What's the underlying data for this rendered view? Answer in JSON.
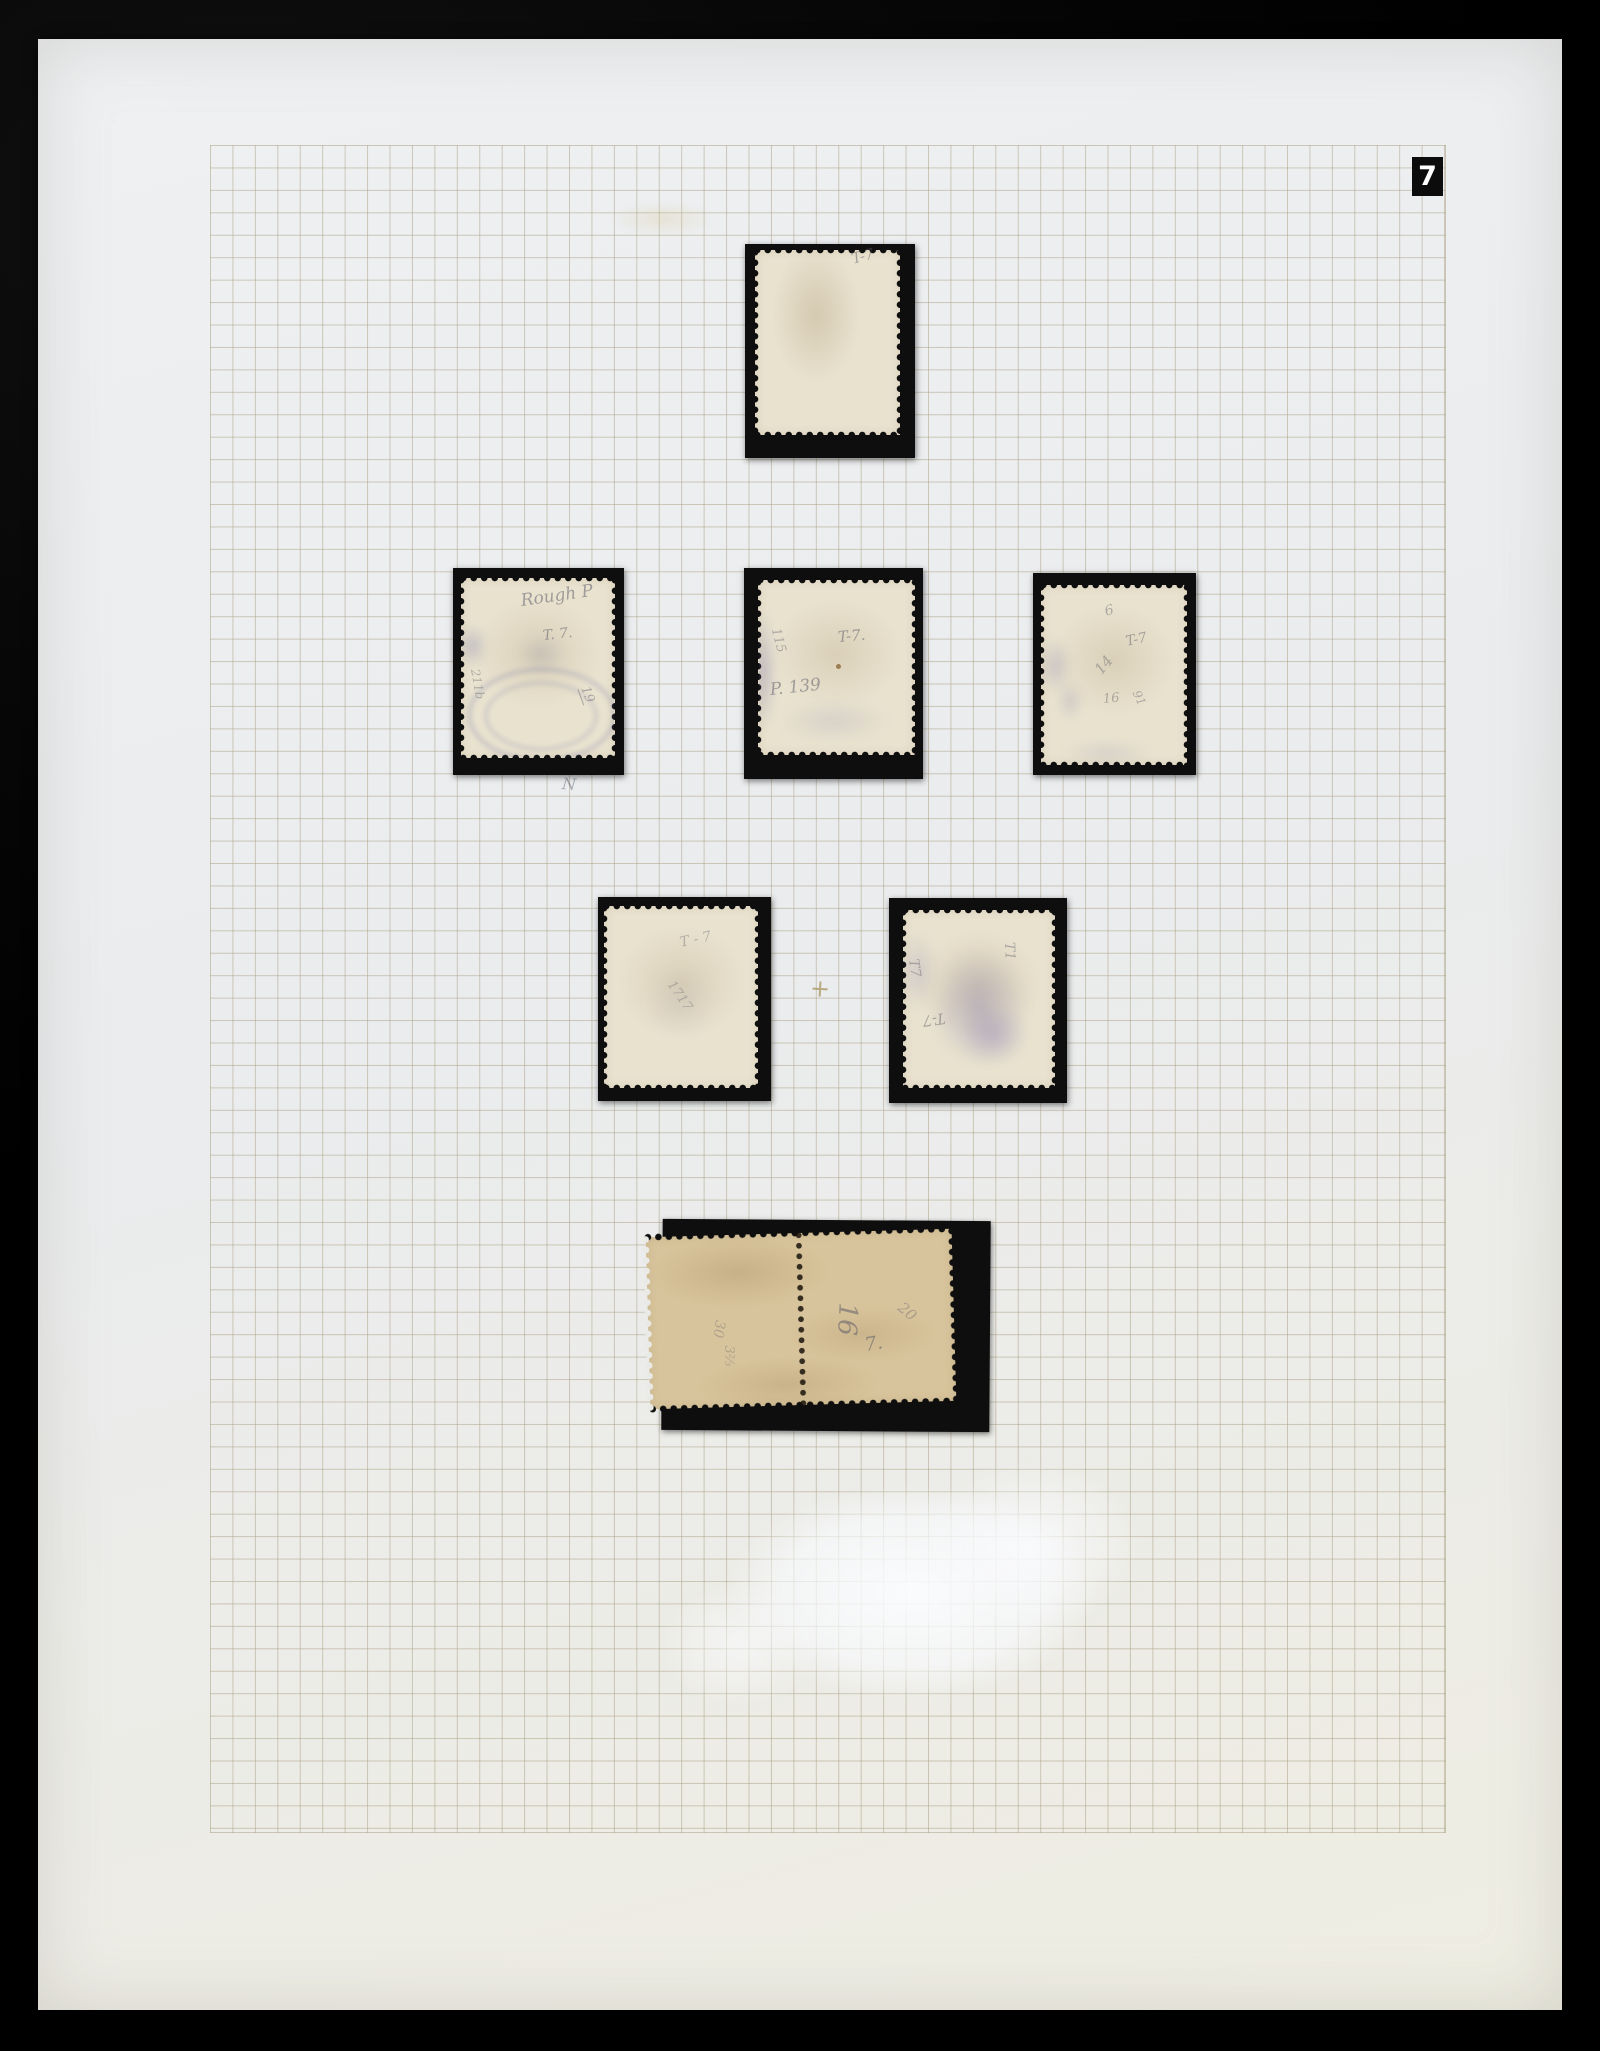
{
  "page": {
    "number": "7"
  },
  "stamps": [
    {
      "id": "single-top",
      "annotations": [
        "T-7"
      ]
    },
    {
      "id": "row2-left",
      "annotations": [
        "Rough P",
        "T. 7.",
        "211b",
        "19"
      ]
    },
    {
      "id": "row2-middle",
      "annotations": [
        "115",
        "T-7.",
        "P. 139"
      ]
    },
    {
      "id": "row2-right",
      "annotations": [
        "6",
        "T-7",
        "14",
        "16",
        "91"
      ]
    },
    {
      "id": "row3-left",
      "annotations": [
        "T - 7",
        "1717"
      ]
    },
    {
      "id": "row3-right",
      "annotations": [
        "T7",
        "T1",
        "T-7"
      ]
    },
    {
      "id": "bottom-pair",
      "annotations": [
        "30",
        "3⅔",
        "16",
        "20",
        "7."
      ]
    }
  ],
  "page_marks": [
    "N",
    "+"
  ],
  "colors": {
    "background": "#060606",
    "page": "#ebedee",
    "grid_line": "#a89e80",
    "mount_black": "#0e0e0e",
    "stamp_cream": "#e9e2cf",
    "stamp_buff": "#d8c49c",
    "cancel_violet": "#6569a5",
    "pencil_gray": "#565664",
    "page_number_box": "#0c0c0c",
    "page_number_text": "#ffffff"
  }
}
